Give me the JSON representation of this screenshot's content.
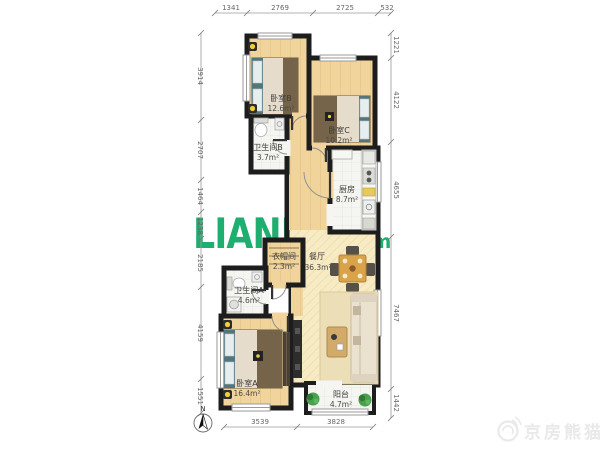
{
  "watermark": {
    "brand": "LIANJIA",
    "brand_cn": "链家",
    "brand_domain": ".com",
    "corner_logo_text": "京房熊猫"
  },
  "compass": {
    "north_label": "N"
  },
  "rooms": [
    {
      "id": "bedroomB",
      "name": "卧室B",
      "area": "12.6m²"
    },
    {
      "id": "bedroomC",
      "name": "卧室C",
      "area": "10.2m²"
    },
    {
      "id": "bathroomB",
      "name": "卫生间B",
      "area": "3.7m²"
    },
    {
      "id": "kitchen",
      "name": "厨房",
      "area": "8.7m²"
    },
    {
      "id": "cloakroom",
      "name": "衣帽间",
      "area": "2.3m²"
    },
    {
      "id": "dining",
      "name": "餐厅",
      "area": "36.3m²"
    },
    {
      "id": "bathroomA",
      "name": "卫生间A",
      "area": "4.6m²"
    },
    {
      "id": "bedroomA",
      "name": "卧室A",
      "area": "16.4m²"
    },
    {
      "id": "balcony",
      "name": "阳台",
      "area": "4.7m²"
    }
  ],
  "dimensions": {
    "top": [
      "1341",
      "2769",
      "2725",
      "532"
    ],
    "bottom": [
      "3539",
      "3828"
    ],
    "left": [
      "3914",
      "2707",
      "1464",
      "1238",
      "2185",
      "4159",
      "1551"
    ],
    "right": [
      "1221",
      "4122",
      "4655",
      "7467",
      "1442"
    ]
  },
  "colors": {
    "wall": "#1d1d1d",
    "wood_floor": "#f0d49c",
    "hall_floor": "#f7ebc5",
    "tile_floor": "#f5f5f1",
    "brand_green": "#00a35c",
    "lamp_yellow": "#f2cd3a",
    "plant_green": "#49a14d"
  }
}
